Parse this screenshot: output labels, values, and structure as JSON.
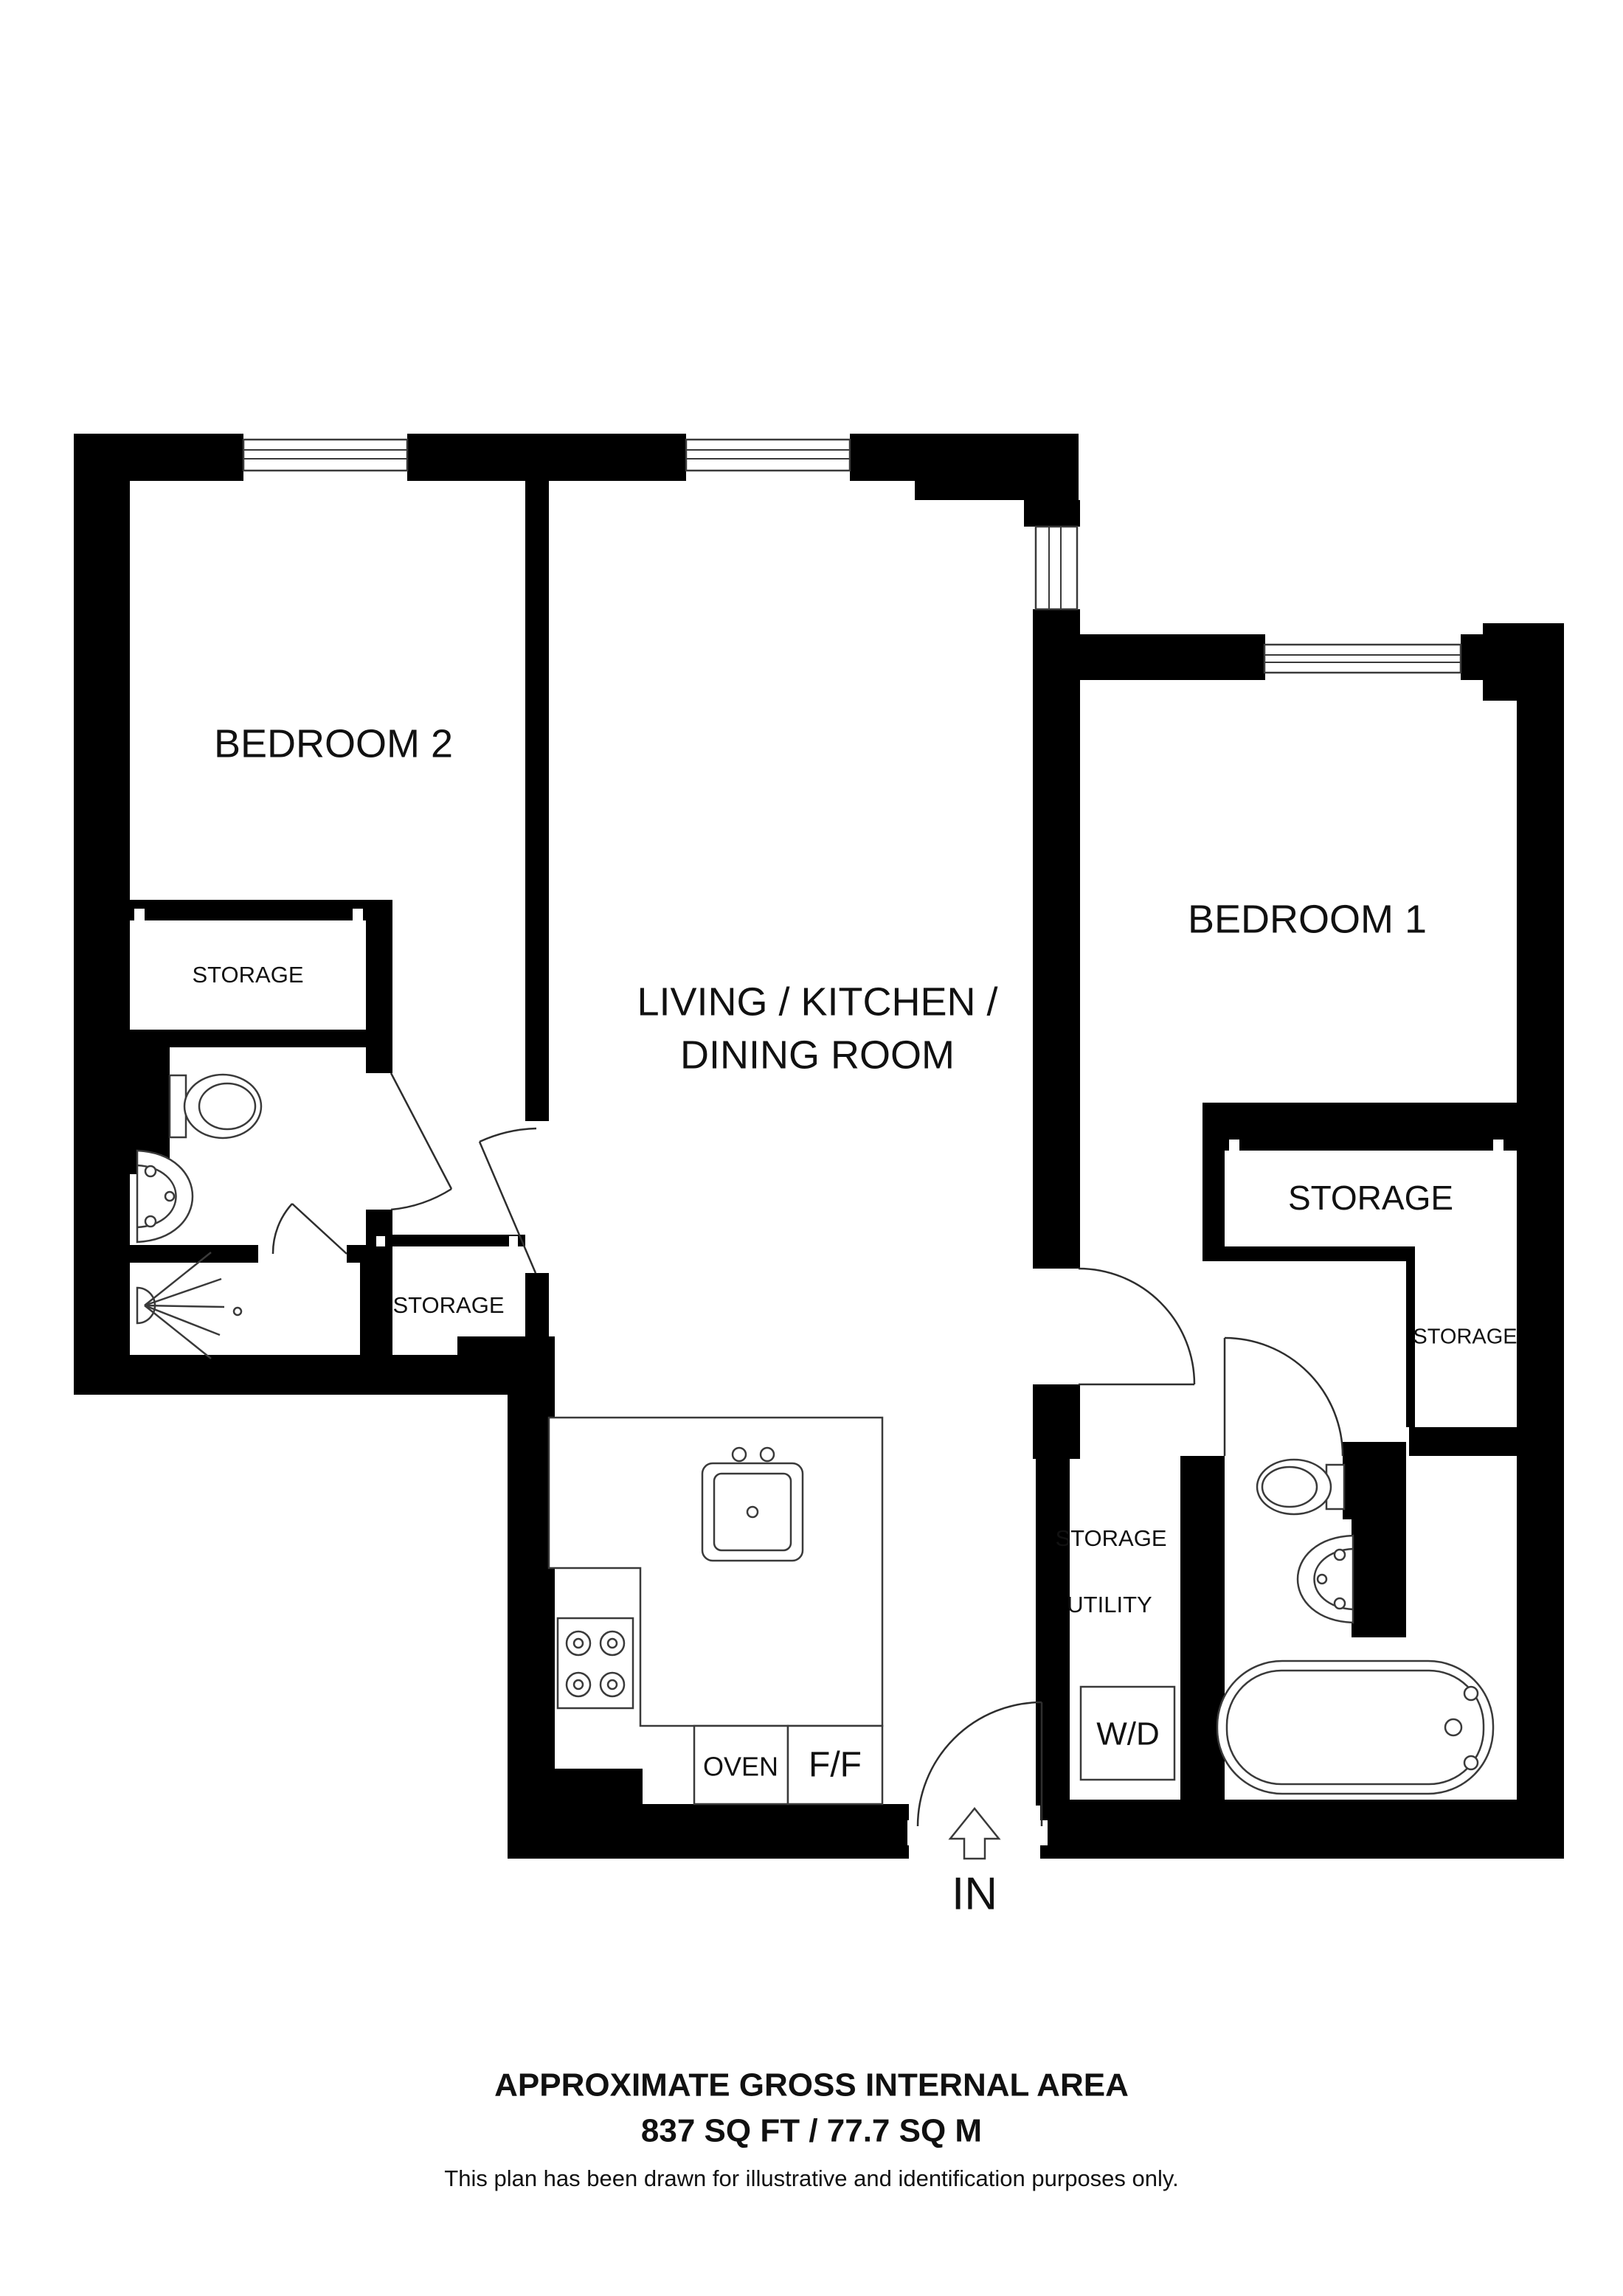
{
  "plan": {
    "rooms": {
      "bedroom2": "BEDROOM 2",
      "living_line1": "LIVING / KITCHEN /",
      "living_line2": "DINING ROOM",
      "bedroom1": "BEDROOM 1"
    },
    "labels": {
      "storage_bedroom2": "STORAGE",
      "storage_shower": "STORAGE",
      "storage_bedroom1": "STORAGE",
      "storage_closet": "STORAGE",
      "storage_utility": "STORAGE",
      "utility": "UTILITY",
      "washer_dryer": "W/D",
      "oven": "OVEN",
      "fridge_freezer": "F/F",
      "entrance": "IN"
    }
  },
  "footer": {
    "title": "APPROXIMATE GROSS INTERNAL AREA",
    "area": "837 SQ FT / 77.7 SQ M",
    "disclaimer": "This plan has been drawn for illustrative and identification purposes only."
  },
  "colors": {
    "wall": "#000000",
    "fixture_line": "#3a3a3a",
    "background": "#ffffff",
    "text": "#111111"
  }
}
